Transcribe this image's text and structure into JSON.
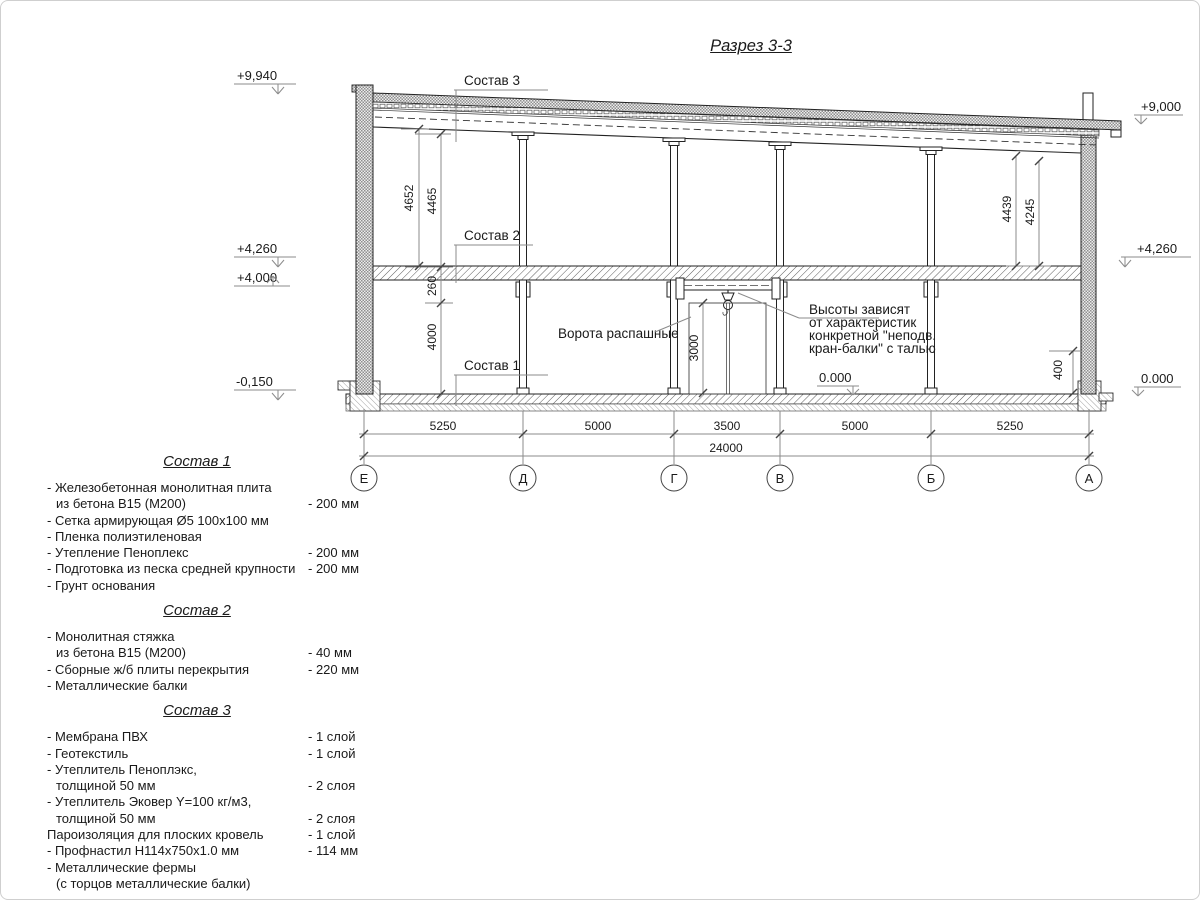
{
  "title": "Разрез 3-3",
  "drawing": {
    "elev": {
      "left_roof": "+9,940",
      "left_floor2": "+4,260",
      "left_floor2b": "+4,000",
      "left_ground": "-0,150",
      "right_roof": "+9,000",
      "right_floor2": "+4,260",
      "right_ground": "0.000",
      "inner_ground": "0.000"
    },
    "vdims": {
      "left_a": "4652",
      "left_b": "4465",
      "mid_a": "260",
      "mid_b": "4000",
      "right_a": "4439",
      "right_b": "4245",
      "plinth": "400",
      "door": "3000"
    },
    "hdims": [
      "5250",
      "5000",
      "3500",
      "5000",
      "5250"
    ],
    "total": "24000",
    "axes": [
      "Е",
      "Д",
      "Г",
      "В",
      "Б",
      "А"
    ],
    "callouts": {
      "sostav1": "Состав 1",
      "sostav2": "Состав 2",
      "sostav3": "Состав 3",
      "gate": "Ворота распашные",
      "note1": "Высоты зависят",
      "note2": "от характеристик",
      "note3": "конкретной \"неподв.",
      "note4": "кран-балки\" с талью"
    }
  },
  "specs": [
    {
      "heading": "Состав 1",
      "rows": [
        {
          "text": "- Железобетонная  монолитная плита",
          "value": "",
          "indent": false
        },
        {
          "text": "из бетона  В15 (М200)",
          "value": "- 200 мм",
          "indent": true
        },
        {
          "text": "- Сетка армирующая Ø5 100х100 мм",
          "value": "",
          "indent": false
        },
        {
          "text": "- Пленка полиэтиленовая",
          "value": "",
          "indent": false
        },
        {
          "text": "- Утепление Пеноплекс",
          "value": "- 200 мм",
          "indent": false
        },
        {
          "text": "- Подготовка из песка средней  крупности",
          "value": "- 200 мм",
          "indent": false
        },
        {
          "text": "- Грунт основания",
          "value": "",
          "indent": false
        }
      ]
    },
    {
      "heading": "Состав 2",
      "rows": [
        {
          "text": "- Монолитная стяжка",
          "value": "",
          "indent": false
        },
        {
          "text": "из бетона В15 (М200)",
          "value": "- 40 мм",
          "indent": true
        },
        {
          "text": "- Сборные ж/б плиты перекрытия",
          "value": "- 220 мм",
          "indent": false
        },
        {
          "text": "- Металлические балки",
          "value": "",
          "indent": false
        }
      ]
    },
    {
      "heading": "Состав 3",
      "rows": [
        {
          "text": "- Мембрана ПВХ",
          "value": "- 1 слой",
          "indent": false
        },
        {
          "text": "- Геотекстиль",
          "value": "- 1 слой",
          "indent": false
        },
        {
          "text": "- Утеплитель Пеноплэкс,",
          "value": "",
          "indent": false
        },
        {
          "text": "толщиной 50 мм",
          "value": "- 2 слоя",
          "indent": true
        },
        {
          "text": "- Утеплитель Эковер Y=100 кг/м3,",
          "value": "",
          "indent": false
        },
        {
          "text": "толщиной 50 мм",
          "value": "- 2 слоя",
          "indent": true
        },
        {
          "text": "Пароизоляция для плоских кровель",
          "value": "- 1 слой",
          "indent": false
        },
        {
          "text": "- Профнастил Н114х750х1.0 мм",
          "value": "- 114 мм",
          "indent": false
        },
        {
          "text": "- Металлические фермы",
          "value": "",
          "indent": false
        },
        {
          "text": "(с торцов металлические балки)",
          "value": "",
          "indent": true
        }
      ]
    }
  ]
}
